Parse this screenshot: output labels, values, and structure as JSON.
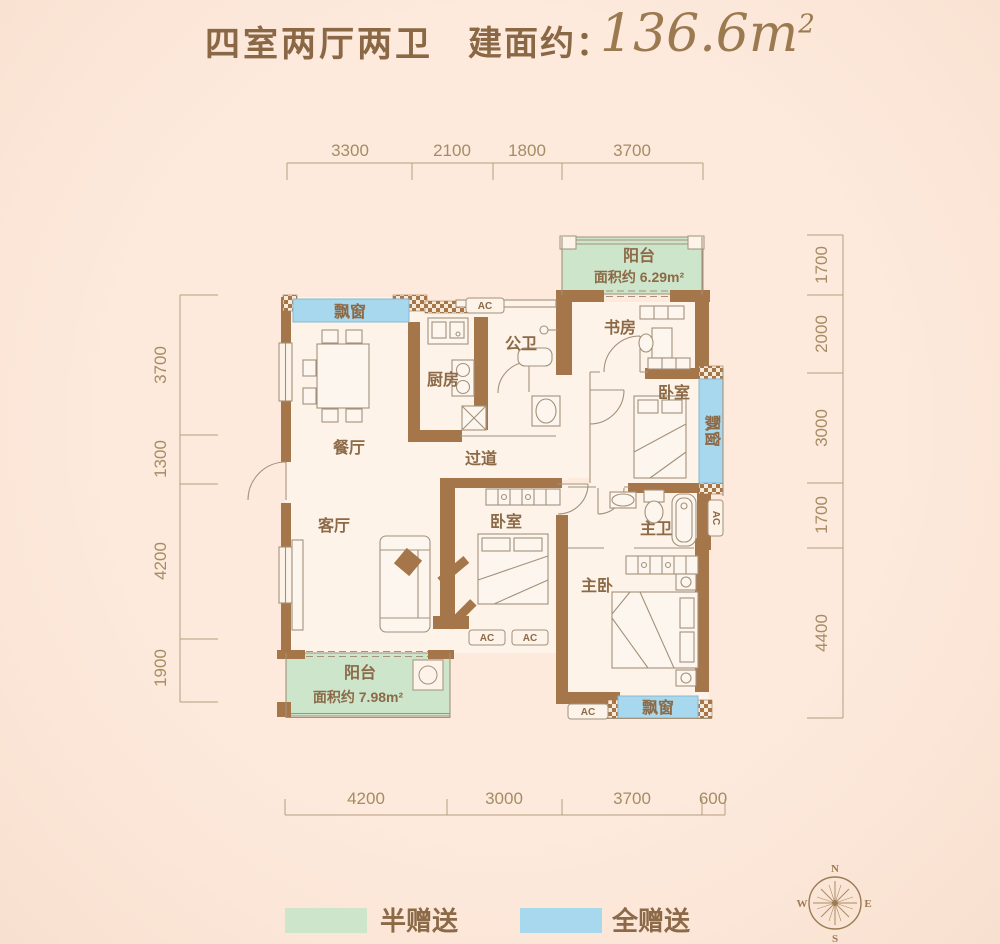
{
  "header": {
    "layout_name": "四室两厅两卫",
    "area_label": "建面约：",
    "area_number": "136.6",
    "area_unit": "m",
    "area_sup": "2"
  },
  "dimensions": {
    "top": [
      "3300",
      "2100",
      "1800",
      "3700"
    ],
    "bottom": [
      "4200",
      "3000",
      "3700",
      "600"
    ],
    "left": [
      "3700",
      "1300",
      "4200",
      "1900"
    ],
    "right": [
      "1700",
      "2000",
      "3000",
      "1700",
      "4400"
    ]
  },
  "rooms": {
    "balcony_top": {
      "label": "阳台",
      "area": "面积约 6.29m²"
    },
    "balcony_bottom": {
      "label": "阳台",
      "area": "面积约 7.98m²"
    },
    "study": {
      "label": "书房"
    },
    "public_bath": {
      "label": "公卫"
    },
    "kitchen": {
      "label": "厨房"
    },
    "dining": {
      "label": "餐厅"
    },
    "corridor": {
      "label": "过道"
    },
    "living": {
      "label": "客厅"
    },
    "bedroom_mid": {
      "label": "卧室"
    },
    "bedroom_right": {
      "label": "卧室"
    },
    "master_bath": {
      "label": "主卫"
    },
    "master_bedroom": {
      "label": "主卧"
    },
    "bay_window": {
      "label": "飘窗"
    },
    "ac": "AC"
  },
  "legend": {
    "half": {
      "label": "半赠送",
      "color": "#cde5cb"
    },
    "full": {
      "label": "全赠送",
      "color": "#a8d8ee"
    }
  },
  "compass": {
    "n": "N",
    "e": "E",
    "s": "S",
    "w": "W"
  },
  "colors": {
    "wall": "#a5764a",
    "line": "#a4917a",
    "room_fill": "#fdf3e9",
    "text_brown": "#8c6a47",
    "dim_line": "#b79d7c"
  }
}
